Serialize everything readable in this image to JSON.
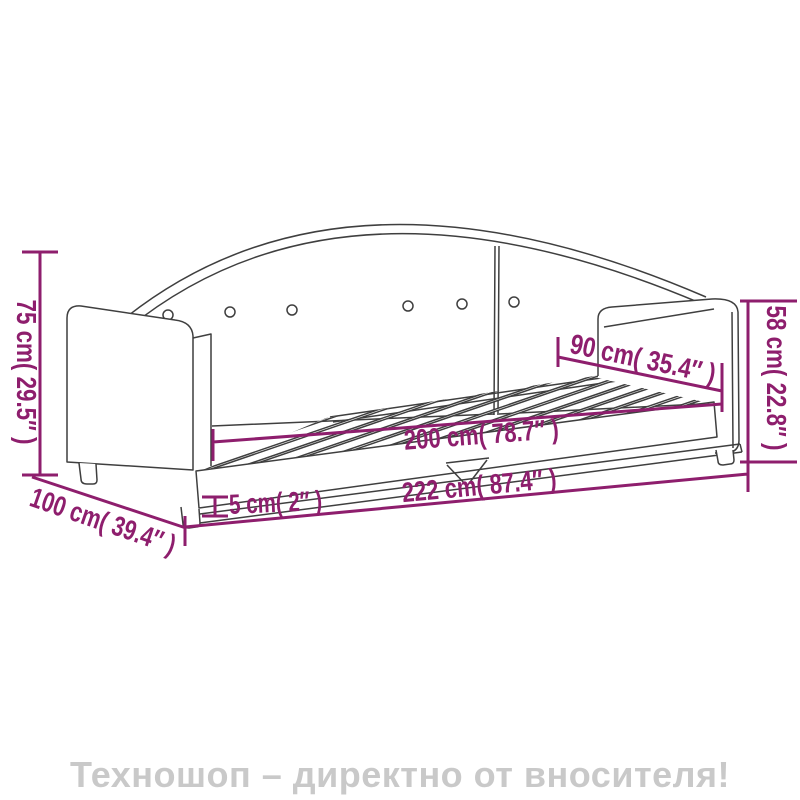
{
  "product_diagram": {
    "subject": "daybed-line-drawing",
    "colors": {
      "dimension": "#8e1e6d",
      "line_art": "#3f3f3f"
    },
    "dimensions": {
      "height": {
        "label": "75 cm( 29.5″ )"
      },
      "arm_height": {
        "label": "58 cm( 22.8″ )"
      },
      "width": {
        "label": "90 cm( 35.4″ )"
      },
      "inner_length": {
        "label": "200 cm( 78.7″ )"
      },
      "leg_height": {
        "label": "5 cm( 2″ )"
      },
      "total_length": {
        "label": "222 cm( 87.4″ )"
      },
      "depth": {
        "label": "100 cm( 39.4″ )"
      }
    }
  },
  "footer": {
    "text": "Техношоп – директно от вносителя!",
    "color": "#c9c9c9"
  }
}
